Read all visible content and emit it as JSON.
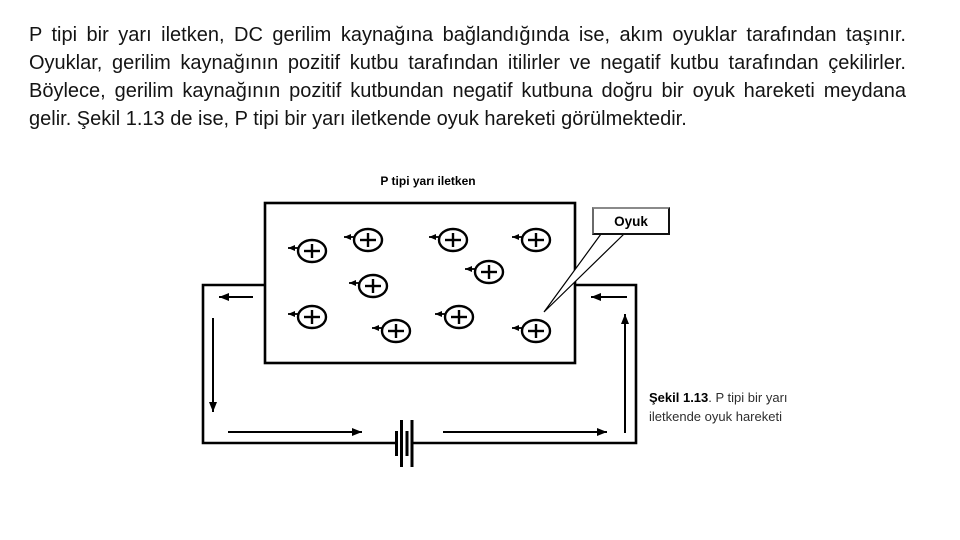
{
  "slide": {
    "background_color": "#ffffff",
    "text_color": "#141414",
    "paragraph": "P tipi bir yarı iletken, DC gerilim kaynağına bağlandığında ise, akım oyuklar tarafından taşınır. Oyuklar, gerilim kaynağının pozitif kutbu tarafından itilirler ve negatif kutbu tarafından çekilirler. Böylece, gerilim kaynağının pozitif kutbundan negatif kutbuna doğru bir oyuk hareketi meydana gelir. Şekil 1.13 de ise, P tipi bir yarı iletkende oyuk hareketi görülmektedir."
  },
  "diagram": {
    "title": "P tipi yarı iletken",
    "line_color": "#000000",
    "callout": {
      "label": "Oyuk"
    },
    "hole": {
      "symbol": "+",
      "count": 10
    },
    "caption": {
      "figure_label": "Şekil 1.13",
      "text": ". P tipi bir yarı iletkende oyuk hareketi"
    }
  }
}
